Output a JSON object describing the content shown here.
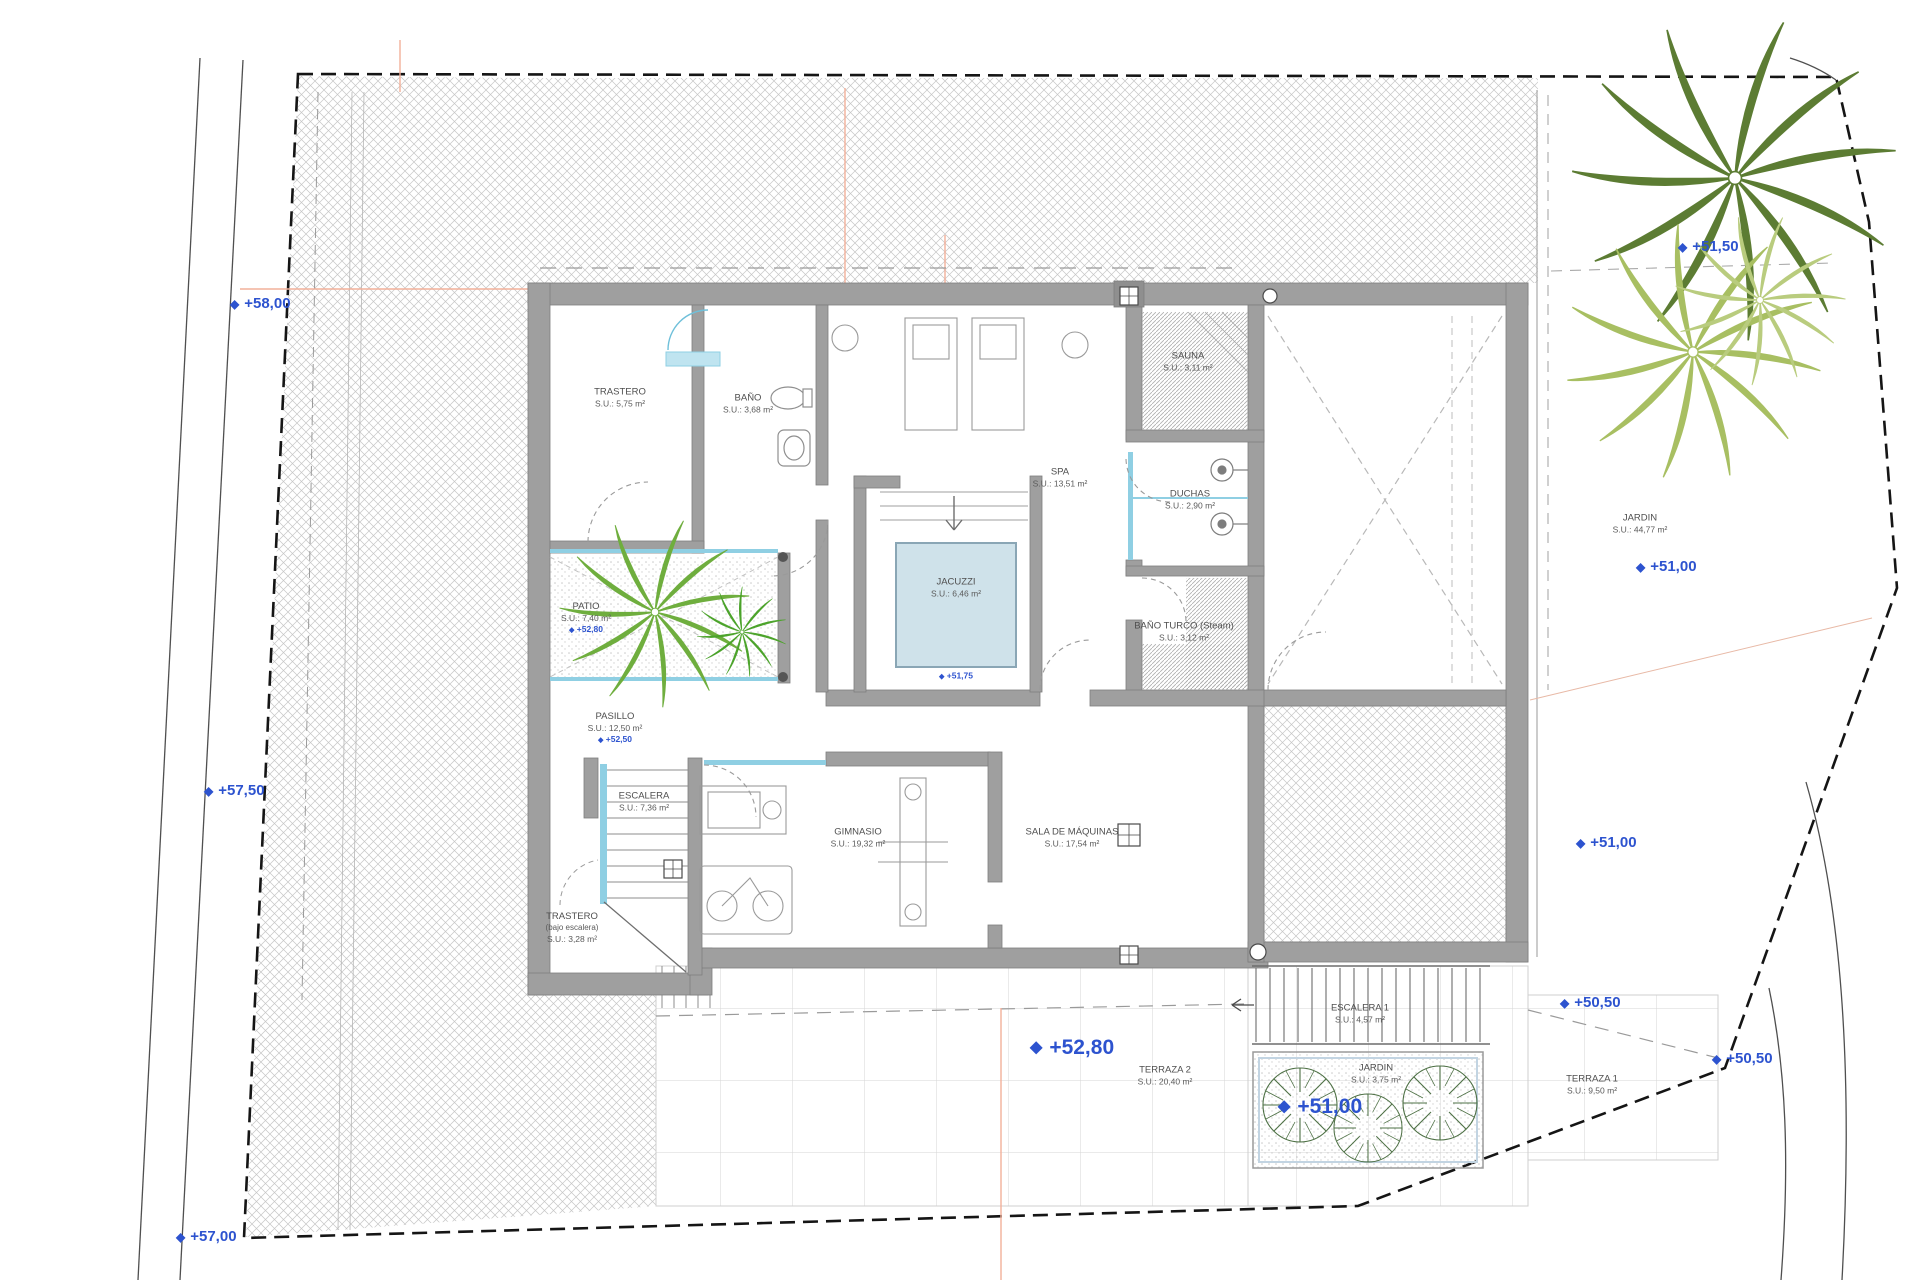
{
  "drawing": {
    "type": "architectural floor plan",
    "floor": "basement / spa level",
    "colors": {
      "accent_blue": "#2d53cf",
      "wall_gray": "#9f9f9f",
      "glass_cyan": "#8fcfe3",
      "water_blue": "#cfe2ea",
      "palm_dark_green": "#5c7c33",
      "palm_light_green": "#a8bf62",
      "patio_palm_green": "#6fae3e",
      "boundary_black": "#151515",
      "reference_orange": "#f2b09a"
    }
  },
  "labels": {
    "trastero": {
      "name": "TRASTERO",
      "area": "S.U.: 5,75 m²"
    },
    "bano": {
      "name": "BAÑO",
      "area": "S.U.: 3,68 m²"
    },
    "spa": {
      "name": "SPA",
      "area": "S.U.: 13,51 m²"
    },
    "sauna": {
      "name": "SAUNA",
      "area": "S.U.: 3,11 m²"
    },
    "duchas": {
      "name": "DUCHAS",
      "area": "S.U.: 2,90 m²"
    },
    "bano_turco": {
      "name": "BAÑO TURCO (Steam)",
      "area": "S.U.: 3,12 m²"
    },
    "jacuzzi": {
      "name": "JACUZZI",
      "area": "S.U.: 6,46 m²",
      "marker": "+51,75"
    },
    "patio": {
      "name": "PATIO",
      "area": "S.U.: 7,40 m²",
      "marker": "+52,80"
    },
    "pasillo": {
      "name": "PASILLO",
      "area": "S.U.: 12,50 m²",
      "marker": "+52,50"
    },
    "escalera": {
      "name": "ESCALERA",
      "area": "S.U.: 7,36 m²"
    },
    "trastero2": {
      "name": "TRASTERO",
      "sub": "(bajo escalera)",
      "area": "S.U.: 3,28 m²"
    },
    "gimnasio": {
      "name": "GIMNASIO",
      "area": "S.U.: 19,32 m²"
    },
    "sala": {
      "name": "SALA DE MÁQUINAS",
      "area": "S.U.: 17,54 m²"
    },
    "escalera1": {
      "name": "ESCALERA 1",
      "area": "S.U.: 4,57 m²"
    },
    "terraza2": {
      "name": "TERRAZA 2",
      "area": "S.U.: 20,40 m²"
    },
    "jardin_planter": {
      "name": "JARDIN",
      "area": "S.U.: 3,75 m²"
    },
    "terraza1": {
      "name": "TERRAZA 1",
      "area": "S.U.: 9,50 m²"
    },
    "jardin": {
      "name": "JARDIN",
      "area": "S.U.: 44,77 m²"
    }
  },
  "markers": {
    "left_top": "+58,00",
    "left_mid": "+57,50",
    "left_bottom": "+57,00",
    "garden_top": "+51,50",
    "garden_mid": "+51,00",
    "garden_low": "+51,00",
    "terrace_right": "+50,50",
    "boundary_right": "+50,50",
    "terrace_main": "+52,80",
    "planter": "+51,00",
    "diamond_icon": "◆"
  }
}
